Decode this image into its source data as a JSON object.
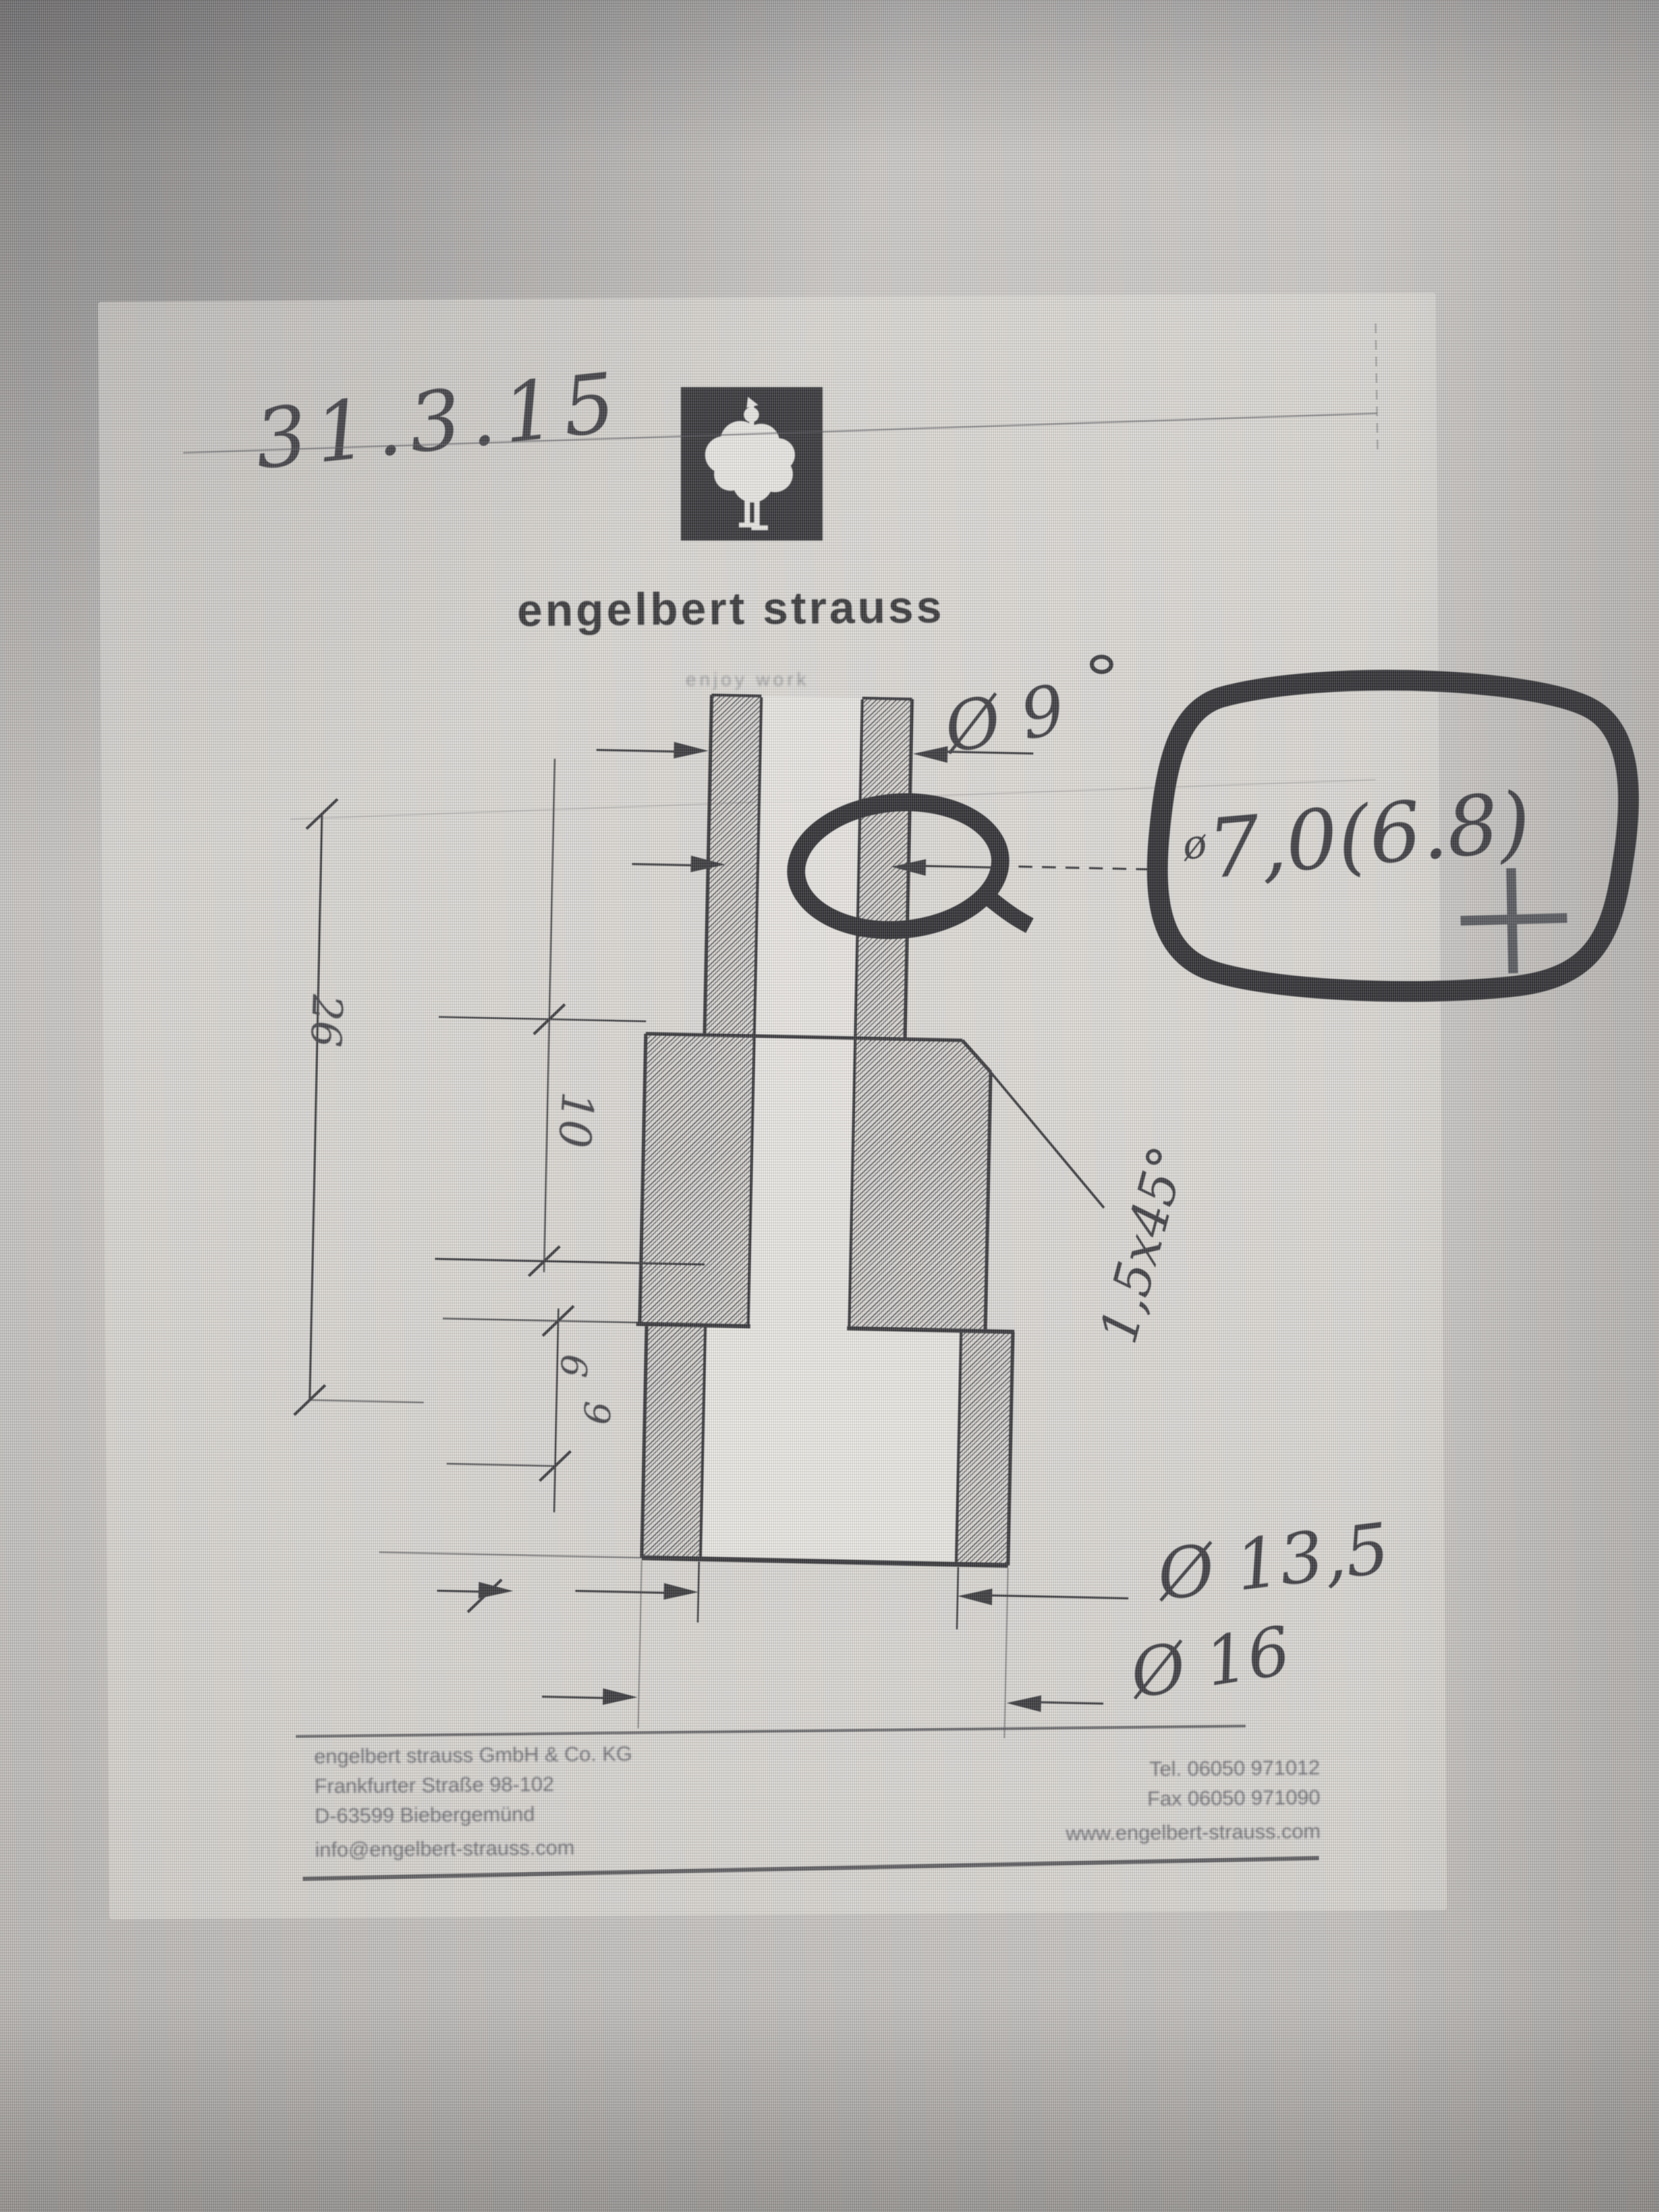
{
  "meta": {
    "date_handwritten": "31.3.15"
  },
  "brand": {
    "wordmark": "engelbert strauss",
    "tagline": "enjoy work"
  },
  "icons": {
    "logo": "rooster-icon",
    "registration_mark": "plus-mark-icon"
  },
  "colors": {
    "ink": "#2a2a2f",
    "marker": "#1f1f24",
    "page": "#e8e6e2",
    "logo_bg": "#26262b",
    "logo_fg": "#eceae7"
  },
  "drawing": {
    "handwritten": {
      "outer_diameter": "Ø 9",
      "bore_prefix": "ø",
      "bore_value_circled": "7,0(6.8)",
      "chamfer": "1,5x45°",
      "counterbore_diameter": "Ø 13,5",
      "flange_diameter": "Ø 16"
    },
    "printed_dimensions": {
      "total_length": "26",
      "body_length": "10",
      "step_small": "6",
      "step_large": "9"
    }
  },
  "footer": {
    "left_lines": [
      "engelbert strauss GmbH & Co. KG",
      "Frankfurter Straße 98-102",
      "D-63599 Biebergemünd",
      "info@engelbert-strauss.com"
    ],
    "right_lines": [
      "Tel. 06050 971012",
      "Fax 06050 971090",
      "www.engelbert-strauss.com"
    ]
  }
}
